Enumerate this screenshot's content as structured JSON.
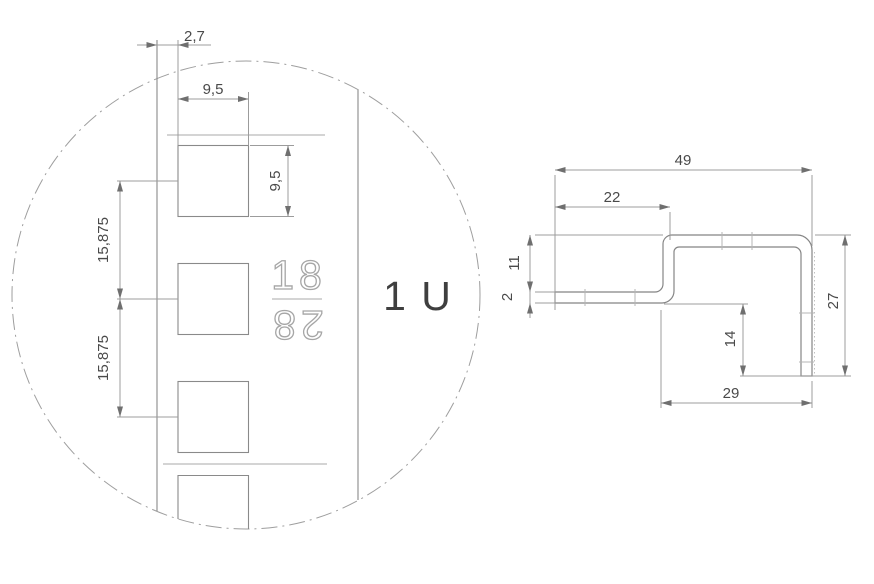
{
  "detail_view": {
    "description_labels": {
      "unit_label": "1 U",
      "stamp_top": "18",
      "stamp_bottom": "28"
    },
    "dimensions": {
      "edge_offset": "2,7",
      "hole_width": "9,5",
      "hole_height": "9,5",
      "hole_pitch_upper": "15,875",
      "hole_pitch_lower": "15,875"
    }
  },
  "profile_view": {
    "dimensions": {
      "total_width": "49",
      "flange_width": "22",
      "step_height": "11",
      "thickness": "2",
      "inner_height": "14",
      "side_height": "27",
      "bottom_width": "29"
    }
  },
  "colors": {
    "background": "#ffffff",
    "outline_line": "#858585",
    "dimension_line": "#9c9c9c",
    "dimension_text": "#4a4a4a",
    "stamp_outline": "#a6a6a6",
    "unit_text": "#3f3f3f"
  }
}
